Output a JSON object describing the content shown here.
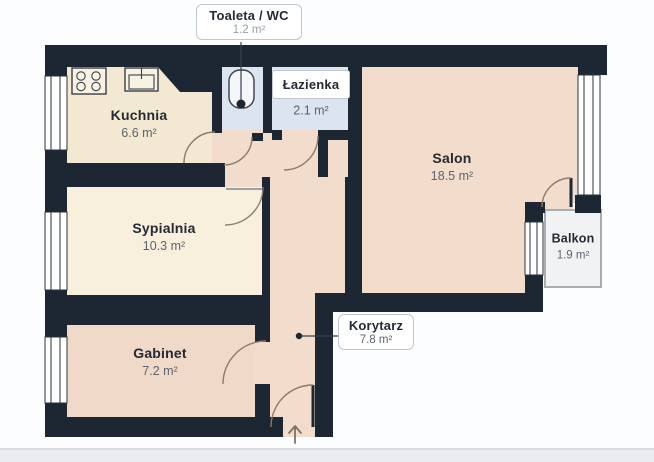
{
  "title": "Rzut mieszkania",
  "rooms": {
    "kuchnia": {
      "name": "Kuchnia",
      "area": "6.6 m²"
    },
    "sypialnia": {
      "name": "Sypialnia",
      "area": "10.3 m²"
    },
    "gabinet": {
      "name": "Gabinet",
      "area": "7.2 m²"
    },
    "salon": {
      "name": "Salon",
      "area": "18.5 m²"
    },
    "balkon": {
      "name": "Balkon",
      "area": "1.9 m²"
    },
    "lazienka": {
      "name": "Łazienka",
      "area": "2.1 m²"
    },
    "toaleta": {
      "name": "Toaleta / WC",
      "area": "1.2 m²"
    },
    "korytarz": {
      "name": "Korytarz",
      "area": "7.8 m²"
    }
  },
  "icons": [
    "stove-icon",
    "sink-icon",
    "toilet-icon",
    "entrance-arrow-icon"
  ],
  "colors": {
    "wall": "#1c2733",
    "floor_cream": "#f3e9d2",
    "floor_cream_light": "#f8efdd",
    "floor_pink": "#f2dccb",
    "floor_pink_deep": "#f0d9c8",
    "floor_blue": "#dce4ef",
    "balcony_floor": "#f1f2f4",
    "door_arc": "#8d7b68",
    "label_text": "#242a33",
    "area_text": "#5d646e"
  }
}
